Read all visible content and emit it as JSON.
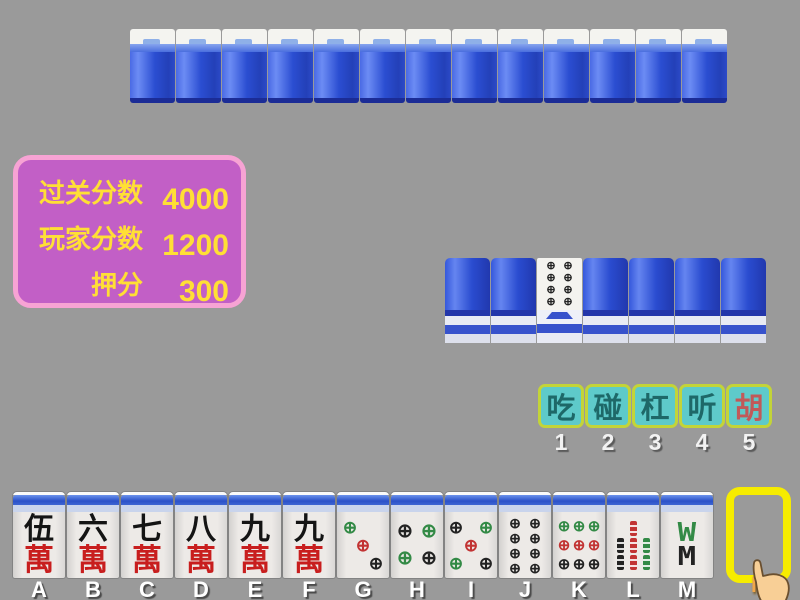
{
  "colors": {
    "background": "#9a9a9a",
    "panel_bg": "#c25fc6",
    "panel_border": "#f7a3d4",
    "panel_text": "#ffdf35",
    "button_bg": "#5ecaca",
    "button_border": "#c3d438",
    "button_text": "#1e6868",
    "button_text_highlight": "#c15959",
    "hotkey_text": "#f2f2f2",
    "hand_letter_text": "#ffffff",
    "draw_letter_text": "#f0a64a",
    "slot_border": "#f6ec00",
    "tile_back_blue": "#2b4ed2",
    "wan_char_black": "#141414",
    "wan_char_red": "#c81e1e",
    "pip_green": "#338a46",
    "pip_red": "#c23333",
    "pip_black": "#232323"
  },
  "icons": {
    "circle_pip": "⊕",
    "bamboo8_top": "W",
    "bamboo8_bottom": "M"
  },
  "score_panel": {
    "rows": [
      {
        "label": "过关分数",
        "value": "4000"
      },
      {
        "label": "玩家分数",
        "value": "1200"
      },
      {
        "label": "押分",
        "value": "300"
      }
    ]
  },
  "opponent_row": {
    "tile_count": 13
  },
  "meld_row": {
    "tiles": [
      {
        "type": "back"
      },
      {
        "type": "back"
      },
      {
        "type": "circle",
        "value": 8
      },
      {
        "type": "back"
      },
      {
        "type": "back"
      },
      {
        "type": "back"
      },
      {
        "type": "back"
      }
    ]
  },
  "action_bar": {
    "buttons": [
      {
        "id": "chi",
        "label": "吃",
        "hotkey": "1"
      },
      {
        "id": "peng",
        "label": "碰",
        "hotkey": "2"
      },
      {
        "id": "gang",
        "label": "杠",
        "hotkey": "3"
      },
      {
        "id": "ting",
        "label": "听",
        "hotkey": "4"
      },
      {
        "id": "hu",
        "label": "胡",
        "hotkey": "5",
        "highlight": true
      }
    ]
  },
  "hand": {
    "tiles": [
      {
        "letter": "A",
        "suit": "wan",
        "rank_char": "伍",
        "suit_char": "萬"
      },
      {
        "letter": "B",
        "suit": "wan",
        "rank_char": "六",
        "suit_char": "萬"
      },
      {
        "letter": "C",
        "suit": "wan",
        "rank_char": "七",
        "suit_char": "萬"
      },
      {
        "letter": "D",
        "suit": "wan",
        "rank_char": "八",
        "suit_char": "萬"
      },
      {
        "letter": "E",
        "suit": "wan",
        "rank_char": "九",
        "suit_char": "萬"
      },
      {
        "letter": "F",
        "suit": "wan",
        "rank_char": "九",
        "suit_char": "萬"
      },
      {
        "letter": "G",
        "suit": "circle",
        "value": 3
      },
      {
        "letter": "H",
        "suit": "circle",
        "value": 4
      },
      {
        "letter": "I",
        "suit": "circle",
        "value": 5
      },
      {
        "letter": "J",
        "suit": "circle",
        "value": 8
      },
      {
        "letter": "K",
        "suit": "circle",
        "value": 9
      },
      {
        "letter": "L",
        "suit": "bamboo",
        "value": 7
      },
      {
        "letter": "M",
        "suit": "bamboo",
        "value": 8
      }
    ],
    "draw_slot_letter": "N"
  }
}
